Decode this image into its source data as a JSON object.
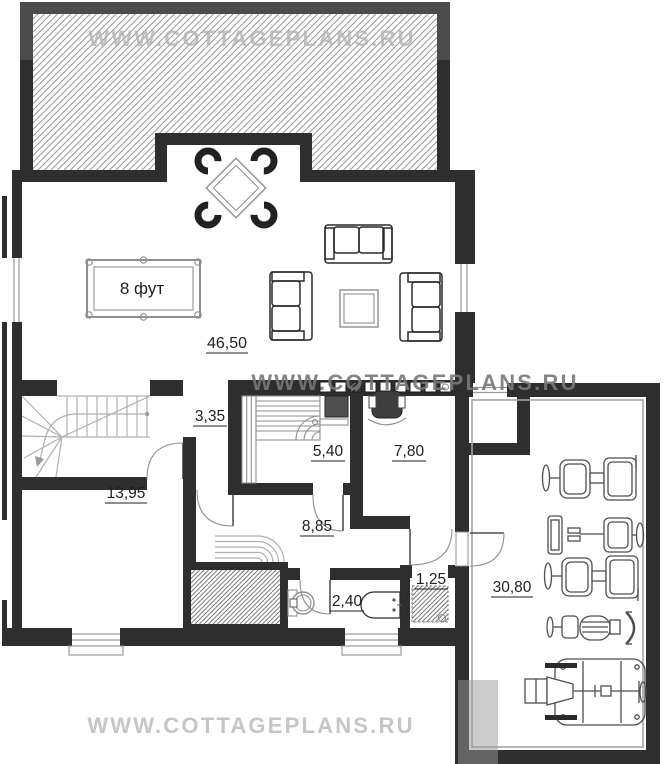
{
  "watermarks": {
    "top": "WWW.COTTAGEPLANS.RU",
    "middle": "WWW.COTTAGEPLANS.RU",
    "bottom": "WWW.COTTAGEPLANS.RU"
  },
  "rooms": {
    "living_billiard": {
      "area": "46,50"
    },
    "hall": {
      "area": "3,35"
    },
    "sauna": {
      "area": "5,40"
    },
    "study": {
      "area": "7,80"
    },
    "corridor": {
      "area": "8,85"
    },
    "room_left": {
      "area": "13,95"
    },
    "bathroom": {
      "area": "2,40"
    },
    "wc": {
      "area": "1,25"
    },
    "gym": {
      "area": "30,80"
    }
  },
  "furniture": {
    "billiard_table_label": "8 фут"
  },
  "colors": {
    "wall": "#2e2e2e",
    "wall_terrace": "#4c4c4c",
    "hatch": "#989898",
    "hatch_dense": "#7d7d7d",
    "glazing": "#9a9a9a",
    "furn_dark": "#2a2a2a",
    "furn_light": "#8f8f8f",
    "stair": "#b0b0b0",
    "door_arc": "#909090",
    "gym": "#4f4f4f",
    "label": "#1f1f1f",
    "wm_top": "#b3b3b3",
    "wm_mid": "#787878",
    "wm_bot": "#c6c6c6"
  }
}
